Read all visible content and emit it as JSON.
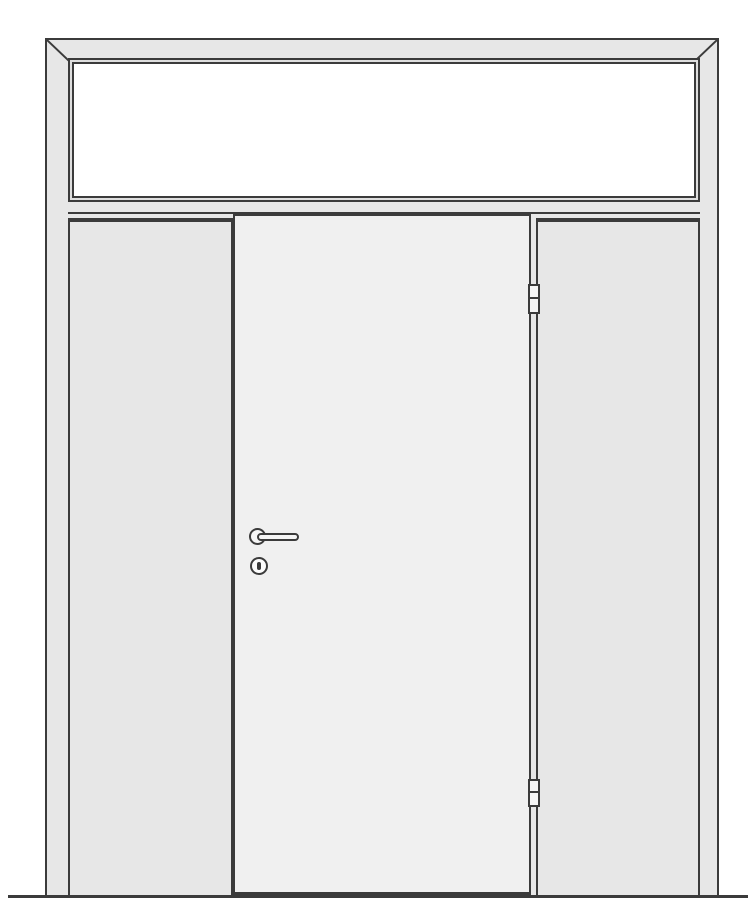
{
  "illustration": {
    "subject": "door-elevation-with-transom-and-sidelights",
    "parts": {
      "outer_frame": "outer frame",
      "transom": "transom window",
      "transom_bar": "transom bar",
      "left_sidelight": "left sidelight",
      "right_sidelight": "right sidelight",
      "door_leaf": "door leaf",
      "handle": "lever handle",
      "keyhole": "cylinder keyhole",
      "hinge_top": "top hinge",
      "hinge_bottom": "bottom hinge",
      "ground": "ground line"
    }
  },
  "colors": {
    "line": "#3b3b3b",
    "frame": "#e7e7e7",
    "gap": "#dedede",
    "leaf": "#f0f0f0",
    "glass": "#ffffff",
    "hardware": "#f5f5f5",
    "background": "#ffffff"
  }
}
